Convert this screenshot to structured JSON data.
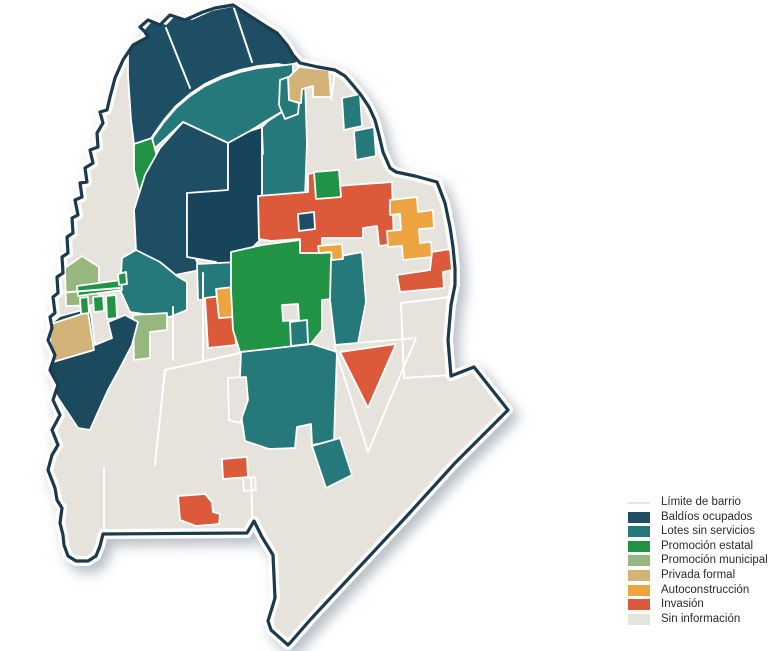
{
  "legend": {
    "items": [
      {
        "id": "limite",
        "label": "Límite de barrio",
        "type": "line",
        "color": "#e9e6e2"
      },
      {
        "id": "baldios",
        "label": "Baldíos ocupados",
        "type": "swatch",
        "color": "#1d4e63"
      },
      {
        "id": "lotes",
        "label": "Lotes sin servicios",
        "type": "swatch",
        "color": "#26797a"
      },
      {
        "id": "estatal",
        "label": "Promoción estatal",
        "type": "swatch",
        "color": "#219345"
      },
      {
        "id": "municipal",
        "label": "Promoción municipal",
        "type": "swatch",
        "color": "#96b87e"
      },
      {
        "id": "privada",
        "label": "Privada formal",
        "type": "swatch",
        "color": "#d3b377"
      },
      {
        "id": "auto",
        "label": "Autoconstrucción",
        "type": "swatch",
        "color": "#eda33f"
      },
      {
        "id": "invasion",
        "label": "Invasión",
        "type": "swatch",
        "color": "#dc5a39"
      },
      {
        "id": "sininfo",
        "label": "Sin información",
        "type": "swatch",
        "color": "#e6e3dc"
      }
    ]
  },
  "map": {
    "width": 778,
    "height": 651,
    "boundary_color": "#1c3a4d",
    "casing_color": "#ffffff",
    "limit_line_color": "#ffffff",
    "colors": {
      "baldios": "#1d4e63",
      "lotes": "#26797a",
      "estatal": "#219345",
      "municipal": "#96b87e",
      "privada": "#d3b377",
      "auto": "#eda33f",
      "invasion": "#dc5a39",
      "sininfo": "#e6e3dc"
    },
    "outer_boundary": "233,5 253,18 267,27 277,33 287,45 293,55 300,63 318,67 335,70 345,76 352,84 361,95 369,107 375,120 379,135 383,152 390,168 396,172 415,176 437,182 445,203 450,227 453,247 455,268 455,285 451,305 448,340 451,376 474,367 508,410 455,463 405,518 350,577 310,620 290,643 288,645 271,630 268,621 275,598 273,555 262,537 254,521 247,533 103,534 100,546 96,556 88,561 76,561 68,556 64,545 63,535 60,523 62,508 57,500 55,488 48,470 52,455 58,445 52,430 60,415 53,400 58,385 50,370 55,355 48,340 52,328 50,317 55,313 53,297 58,293 57,277 63,273 62,257 68,253 67,237 73,233 72,218 78,215 75,200 82,197 80,183 87,182 85,168 93,163 90,150 98,147 97,133 103,123 100,112 107,110 110,97 115,78 123,60 133,45 148,37 145,32 140,27 148,20 160,25 170,15 185,20 203,12 215,8",
    "regions": [
      {
        "name": "north-cap",
        "cat": "baldios",
        "pts": "128,48 146,27 153,19 166,24 176,14 192,19 212,10 233,6 253,18 267,27 277,33 287,45 293,55 299,62 288,66 278,64 258,66 240,70 222,76 205,84 190,94 176,106 164,120 154,134 145,148 136,160 131,120 128,75"
      },
      {
        "name": "north-band",
        "cat": "lotes",
        "pts": "145,150 154,136 164,122 176,108 190,96 205,86 222,78 240,72 258,68 278,66 293,64 293,95 283,111 266,121 250,131 234,140 228,143 183,122 166,138 155,148"
      },
      {
        "name": "west-sliver-1",
        "cat": "estatal",
        "pts": "134,144 152,138 158,160 152,190 140,196 134,170"
      },
      {
        "name": "west-sliver-2",
        "cat": "estatal",
        "pts": "140,202 152,198 150,226 141,224"
      },
      {
        "name": "center-west",
        "cat": "baldios",
        "pts": "160,148 183,122 228,143 228,192 187,193 187,235 200,270 175,275 150,258 136,250 134,210 145,175"
      },
      {
        "name": "center-ne",
        "cat": "lotes",
        "pts": "262,127 268,121 285,110 293,96 293,80 305,79 307,143 305,197 262,196 262,148"
      },
      {
        "name": "notch-c",
        "cat": "sininfo",
        "pts": "247,133 262,131 263,154 248,156"
      },
      {
        "name": "center-dark-block",
        "cat": "baldios",
        "fill": "#17445a",
        "pts": "187,193 228,190 228,143 250,131 262,127 262,196 260,240 238,262 238,273 216,272 216,262 187,257"
      },
      {
        "name": "center-south-strip",
        "cat": "lotes",
        "pts": "197,264 238,262 238,273 236,298 198,300"
      },
      {
        "name": "west-mid-teal",
        "cat": "lotes",
        "pts": "122,258 136,250 160,262 177,276 187,282 187,310 170,317 150,315 130,312 120,290"
      },
      {
        "name": "sage-L",
        "cat": "municipal",
        "pts": "133,315 167,313 167,330 150,332 150,358 134,360"
      },
      {
        "name": "center-red-col",
        "cat": "invasion",
        "pts": "205,298 220,296 221,318 234,316 236,345 208,348"
      },
      {
        "name": "center-orange",
        "cat": "auto",
        "pts": "216,289 233,287 234,317 219,318"
      },
      {
        "name": "green-big",
        "cat": "estatal",
        "pts": "231,252 262,245 300,240 322,238 323,253 337,252 341,298 322,300 322,330 310,345 240,352 233,330 231,290"
      },
      {
        "name": "notch-green",
        "cat": "sininfo",
        "pts": "282,305 298,304 299,320 283,321"
      },
      {
        "name": "teal-sq-green",
        "cat": "lotes",
        "pts": "290,322 307,320 308,344 291,346"
      },
      {
        "name": "teal-east-wedge",
        "cat": "lotes",
        "pts": "331,258 362,252 366,302 357,348 336,352 330,300"
      },
      {
        "name": "south-teal-main",
        "cat": "lotes",
        "pts": "241,352 312,344 337,352 334,441 312,445 311,424 297,427 295,448 269,449 245,441 239,400"
      },
      {
        "name": "south-teal-col",
        "cat": "lotes",
        "pts": "312,446 340,438 352,475 326,488"
      },
      {
        "name": "invasion-main",
        "cat": "invasion",
        "pts": "258,196 308,192 308,174 318,172 318,188 350,185 392,182 394,244 379,246 377,226 363,228 363,238 322,238 322,253 300,253 300,239 271,241 259,239"
      },
      {
        "name": "navy-sq-red",
        "cat": "baldios",
        "pts": "298,214 314,212 315,229 299,231"
      },
      {
        "name": "green-sq-red",
        "cat": "estatal",
        "pts": "314,172 339,170 341,197 316,199"
      },
      {
        "name": "orange-cross-ne",
        "cat": "auto",
        "pts": "390,200 417,197 418,212 433,210 434,228 419,229 420,243 431,242 432,257 403,260 402,246 388,247 387,231 401,230 400,214 390,215"
      },
      {
        "name": "red-hook-ne",
        "cat": "invasion",
        "pts": "397,275 430,270 432,252 450,249 452,270 443,272 444,288 400,292"
      },
      {
        "name": "orange-small-mid",
        "cat": "auto",
        "pts": "318,246 342,244 343,259 332,260 331,252 319,253"
      },
      {
        "name": "tan-ne",
        "cat": "privada",
        "pts": "288,78 299,67 329,70 331,97 313,97 313,86 302,89 301,103 289,101"
      },
      {
        "name": "teal-ne-1",
        "cat": "lotes",
        "pts": "280,80 288,77 289,100 299,103 298,114 285,119 279,105"
      },
      {
        "name": "teal-ne-2",
        "cat": "lotes",
        "pts": "342,98 360,94 362,126 344,130"
      },
      {
        "name": "teal-ne-3",
        "cat": "lotes",
        "pts": "354,131 374,127 376,156 356,160"
      },
      {
        "name": "west-navy-blob",
        "cat": "baldios",
        "fill": "#1b4a5f",
        "pts": "33,338 60,316 90,308 95,345 112,338 108,322 125,315 138,322 132,345 120,368 108,390 98,412 90,430 78,428 58,398 42,370 33,352"
      },
      {
        "name": "tan-west",
        "cat": "privada",
        "pts": "48,325 88,312 94,350 53,362"
      },
      {
        "name": "sage-house",
        "cat": "municipal",
        "pts": "65,268 82,256 99,267 99,305 66,306"
      },
      {
        "name": "green-bar",
        "cat": "estatal",
        "pts": "77,286 121,280 122,290 78,296"
      },
      {
        "name": "green-v1",
        "cat": "estatal",
        "pts": "80,298 88,297 89,313 81,314"
      },
      {
        "name": "green-v2",
        "cat": "estatal",
        "pts": "93,297 103,296 104,311 94,312"
      },
      {
        "name": "green-v3",
        "cat": "estatal",
        "pts": "106,296 116,295 117,318 107,319"
      },
      {
        "name": "green-dot",
        "cat": "estatal",
        "pts": "118,274 126,272 127,284 119,285"
      },
      {
        "name": "gray-triangle-se",
        "cat": "sininfo",
        "pts": "334,345 416,338 368,452"
      },
      {
        "name": "red-triangle-se",
        "cat": "invasion",
        "pts": "340,352 396,344 368,408"
      },
      {
        "name": "red-small-south",
        "cat": "invasion",
        "pts": "222,459 247,457 248,477 223,479"
      },
      {
        "name": "gray-sq-south",
        "cat": "sininfo",
        "pts": "243,478 255,477 256,490 244,491"
      },
      {
        "name": "red-blob-south",
        "cat": "invasion",
        "pts": "178,496 205,494 212,502 213,512 220,514 219,524 196,526 180,520"
      },
      {
        "name": "gray-pent-south",
        "cat": "sininfo",
        "pts": "228,378 246,377 248,400 240,423 229,420"
      }
    ],
    "limit_lines": [
      "104,468 104,533",
      "58,293 120,288",
      "240,353 165,370 155,465",
      "251,478 253,534",
      "450,297 401,303 404,378 451,375",
      "234,8 252,62",
      "166,28 190,88",
      "203,273 203,360",
      "173,307 173,360",
      "335,72 331,100"
    ]
  }
}
